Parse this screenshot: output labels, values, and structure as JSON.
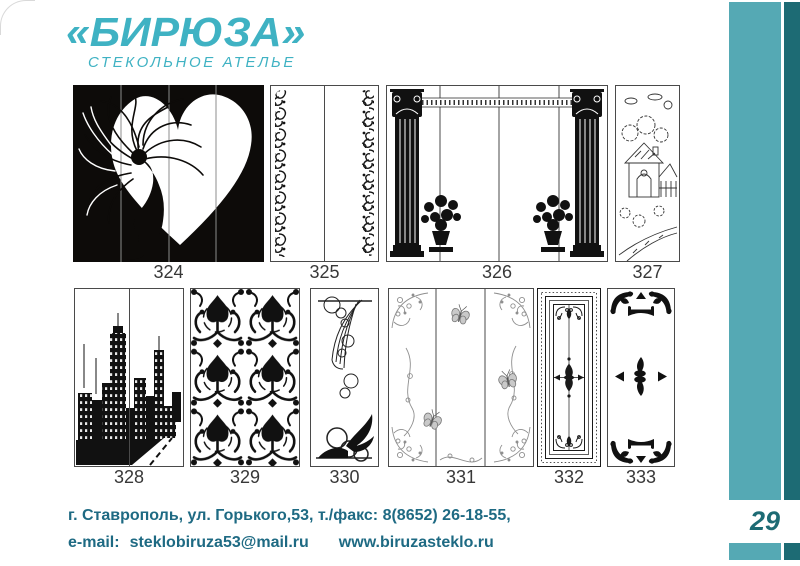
{
  "logo": {
    "title": "«БИРЮЗА»",
    "subtitle": "СТЕКОЛЬНОЕ  АТЕЛЬЕ"
  },
  "designs": [
    {
      "number": "324",
      "motif": "woman-silhouette-with-heart"
    },
    {
      "number": "325",
      "motif": "ornamental-scroll-side-strips"
    },
    {
      "number": "326",
      "motif": "classical-columns-with-flower-urns"
    },
    {
      "number": "327",
      "motif": "village-houses-line-art"
    },
    {
      "number": "328",
      "motif": "city-skyline-silhouette"
    },
    {
      "number": "329",
      "motif": "damask-baroque-pattern"
    },
    {
      "number": "330",
      "motif": "abstract-swirls-and-circles"
    },
    {
      "number": "331",
      "motif": "floral-corners-with-butterflies"
    },
    {
      "number": "332",
      "motif": "nested-frame-vitrage"
    },
    {
      "number": "333",
      "motif": "corner-brackets-center-medallion"
    }
  ],
  "footer": {
    "line1": "г. Ставрополь, ул. Горького,53, т./факс: 8(8652) 26-18-55,",
    "email_label": "e-mail:",
    "email": "steklobiruza53@mail.ru",
    "website": "www.biruzasteklo.ru"
  },
  "page_number": "29",
  "colors": {
    "logo_turquoise": "#3fb2c3",
    "stripe_mid": "#55a9b4",
    "stripe_dark": "#1d6b74",
    "footer_text": "#1e6a83",
    "label_gray": "#383838"
  }
}
